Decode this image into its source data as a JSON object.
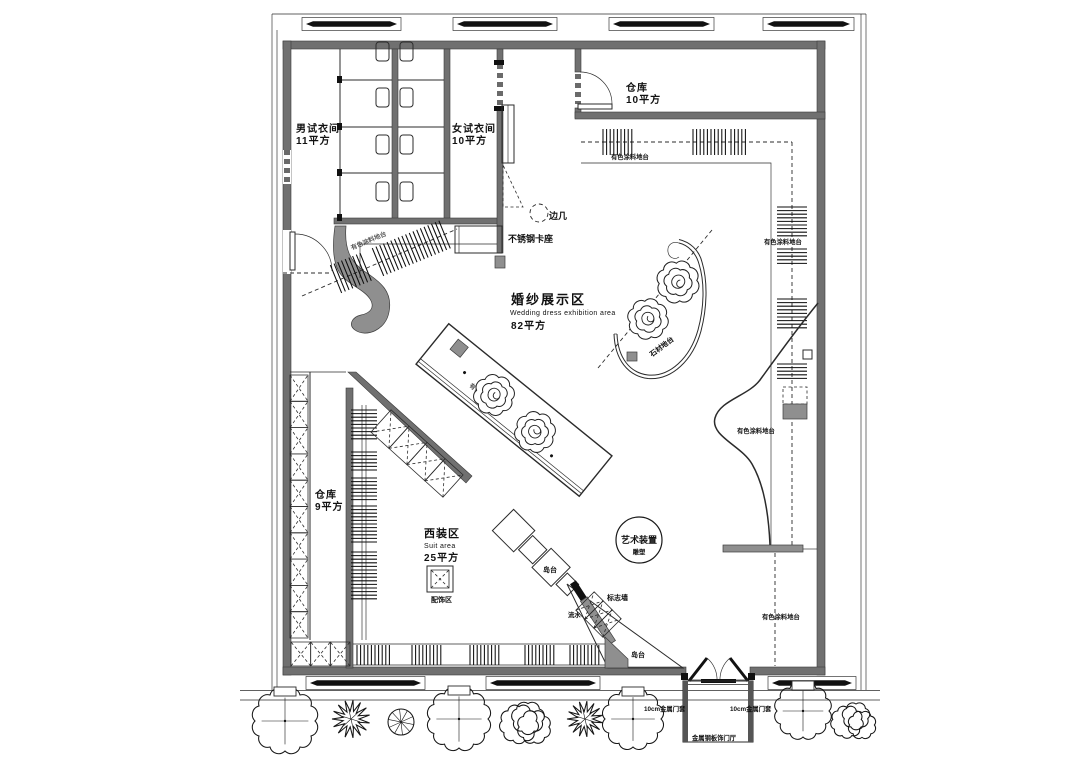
{
  "colors": {
    "background": "#ffffff",
    "wall_fill": "#707070",
    "panel_fill": "#8f8f8f",
    "line_color": "#1a1a1a"
  },
  "labels": {
    "mens_fitting_name": "男试衣间",
    "mens_fitting_area": "11平方",
    "womens_fitting_name": "女试衣间",
    "womens_fitting_area": "10平方",
    "storage_top_name": "仓库",
    "storage_top_area": "10平方",
    "side_table": "边几",
    "steel_booth": "不锈钢卡座",
    "wedding_name": "婚纱展示区",
    "wedding_name_en": "Wedding dress exhibition area",
    "wedding_area": "82平方",
    "stone_platform": "石材地台",
    "paint_platform": "有色涂料地台",
    "storage_left_name": "仓库",
    "storage_left_area": "9平方",
    "suit_name": "西装区",
    "suit_name_en": "Suit area",
    "suit_area": "25平方",
    "accessories_zone": "配饰区",
    "island_counter": "岛台",
    "logo_wall": "标志墙",
    "water_feature": "流水",
    "art_installation": "艺术装置",
    "art_installation_sub": "雕塑",
    "metal_door_frame": "10cm金属门套",
    "entrance_vestibule": "金属钢板饰门厅"
  }
}
